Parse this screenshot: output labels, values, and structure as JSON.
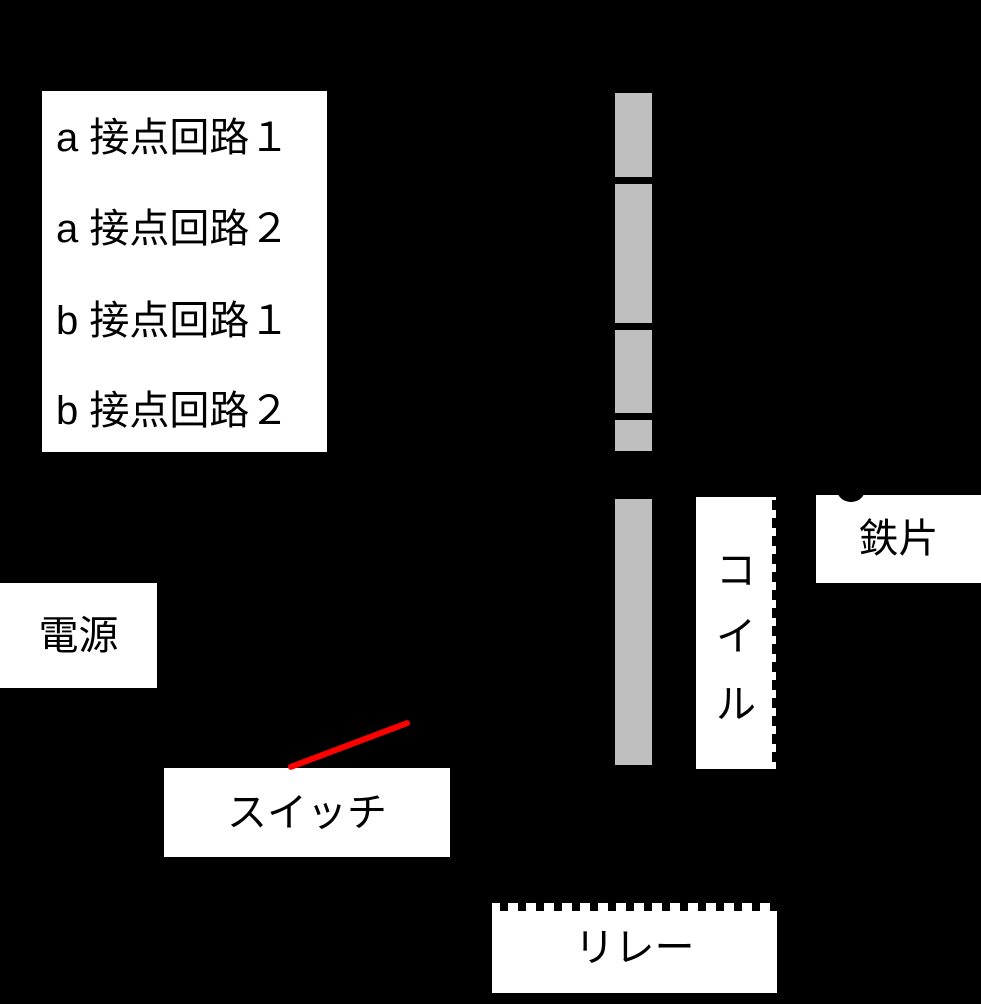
{
  "labels": {
    "contact_circuits": [
      "a 接点回路１",
      "a 接点回路２",
      "b 接点回路１",
      "b 接点回路２"
    ],
    "power": "電源",
    "switch": "スイッチ",
    "coil_chars": [
      "コ",
      "イ",
      "ル"
    ],
    "iron_piece": "鉄片",
    "relay": "リレー"
  },
  "colors": {
    "background": "#000000",
    "label_box": "#ffffff",
    "bar_gray": "#bfbfbf",
    "switch_line_red": "#ff0000",
    "text": "#000000"
  }
}
